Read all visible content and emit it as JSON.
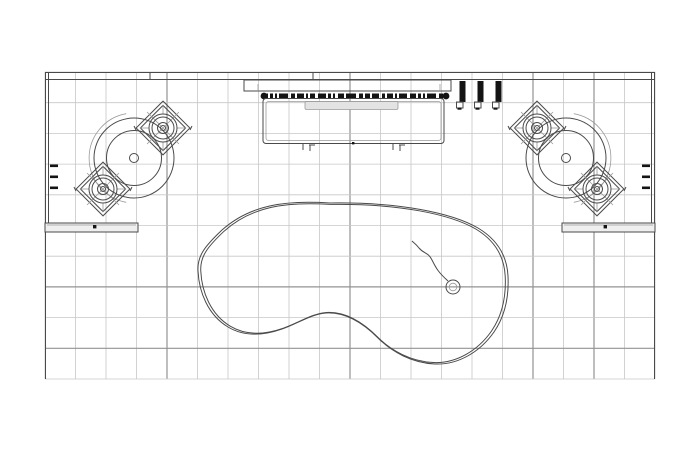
{
  "canvas": {
    "width": 700,
    "height": 450,
    "background": "#ffffff"
  },
  "colors": {
    "line": "#4a4a4a",
    "line_light": "#9a9a9a",
    "grid_minor": "#c7c7c7",
    "grid_major": "#939393",
    "black_fill": "#141414",
    "gray_fill": "#e3e3e3",
    "shelf_fill": "#efefef"
  },
  "grid": {
    "x0": 45,
    "y0": 72,
    "cols": 20,
    "rows": 10,
    "cell_w": 30.5,
    "cell_h": 30.7,
    "major_col_indexes": [
      4,
      10,
      16,
      18
    ],
    "major_row_indexes": [
      7,
      9
    ]
  },
  "drawing": {
    "kind": "CAD plan-view line drawing (no visible text)",
    "components": [
      "perimeter-wall",
      "floor-grid",
      "left-station: turntable platter with two 45-degree speaker cabinets and service shelf",
      "right-station: mirrored turntable platter with two 45-degree speaker cabinets and service shelf",
      "top-center console with fader strip and gray insert panel",
      "three black equipment bars with base plates",
      "kidney-shaped pool outline (double line)",
      "small drain circle with curved cord inside pool",
      "three wall-mounted tick symbols on left wall",
      "three wall-mounted tick symbols on right wall"
    ]
  }
}
